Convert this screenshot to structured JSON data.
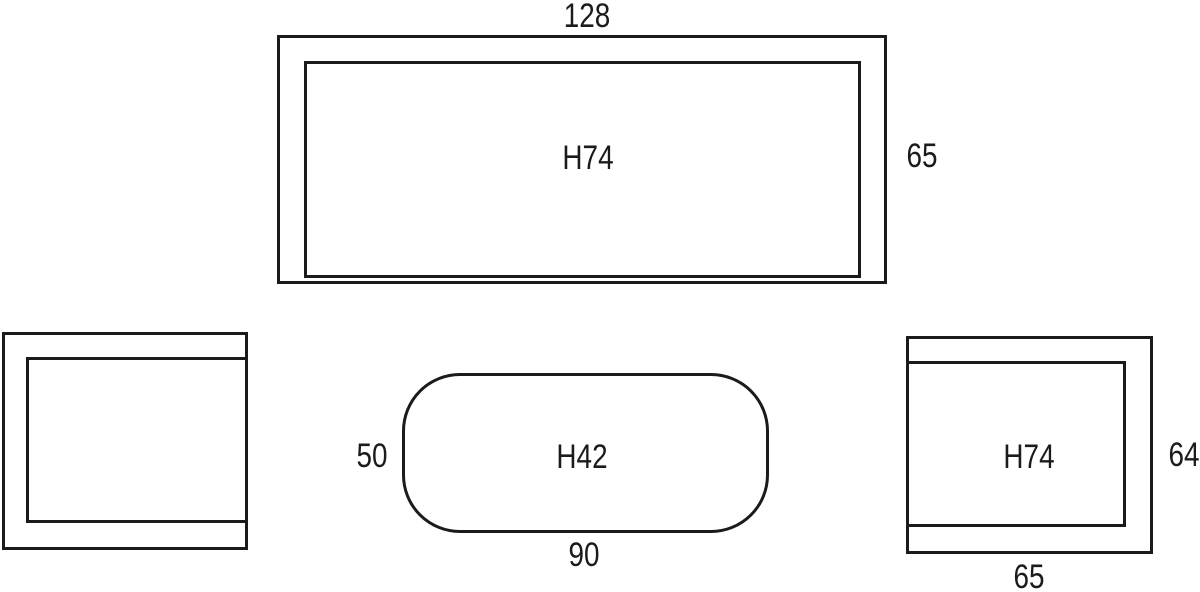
{
  "colors": {
    "background": "#ffffff",
    "line": "#1b1b1b",
    "text": "#1b1b1b"
  },
  "diagram": {
    "sofa": {
      "width_dim": "128",
      "height_label": "H74",
      "depth_dim": "65"
    },
    "coffee_table": {
      "depth_dim": "50",
      "height_label": "H42",
      "width_dim": "90"
    },
    "armchair_right": {
      "height_label": "H74",
      "depth_dim": "64",
      "width_dim": "65"
    }
  }
}
